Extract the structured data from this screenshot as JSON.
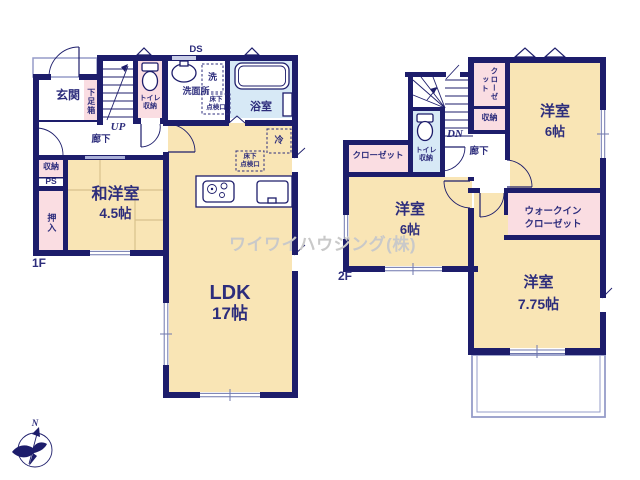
{
  "watermark": "ワイワイハウジング(株)",
  "compass": {
    "north_label": "N"
  },
  "colors": {
    "wall": "#1d1d6b",
    "ink": "#2d2d7c",
    "beige": "#f9e5b5",
    "pink": "#fadde2",
    "blue": "#d7e9f6",
    "light": "#959cc9",
    "tatami": "#d8c18d",
    "wm": "#c9c9c9"
  },
  "floor1": {
    "floor_label": "1F",
    "entrance": "玄関",
    "shoe_box": "下足箱",
    "toilet_storage": "トイレ\n収納",
    "washroom": "洗面所",
    "duct_space": "DS",
    "washer": "洗",
    "bathroom": "浴室",
    "hallway": "廊下",
    "stairs_up": "UP",
    "storage": "収納",
    "pipe_space": "PS",
    "futon_closet": "押入",
    "jw_room_name": "和洋室",
    "jw_room_size": "4.5帖",
    "ldk_name": "LDK",
    "ldk_size": "17帖",
    "fridge": "冷",
    "floor_hatch_1": "床下\n点検口",
    "floor_hatch_2": "床下\n点検口"
  },
  "floor2": {
    "floor_label": "2F",
    "closet_top": "クローゼット",
    "storage": "収納",
    "bedroom1_name": "洋室",
    "bedroom1_size": "6帖",
    "closet_left": "クローゼット",
    "toilet_storage": "トイレ\n収納",
    "hallway": "廊下",
    "stairs_down": "DN",
    "bedroom2_name": "洋室",
    "bedroom2_size": "6帖",
    "wic_line1": "ウォークイン",
    "wic_line2": "クローゼット",
    "bedroom3_name": "洋室",
    "bedroom3_size": "7.75帖"
  }
}
